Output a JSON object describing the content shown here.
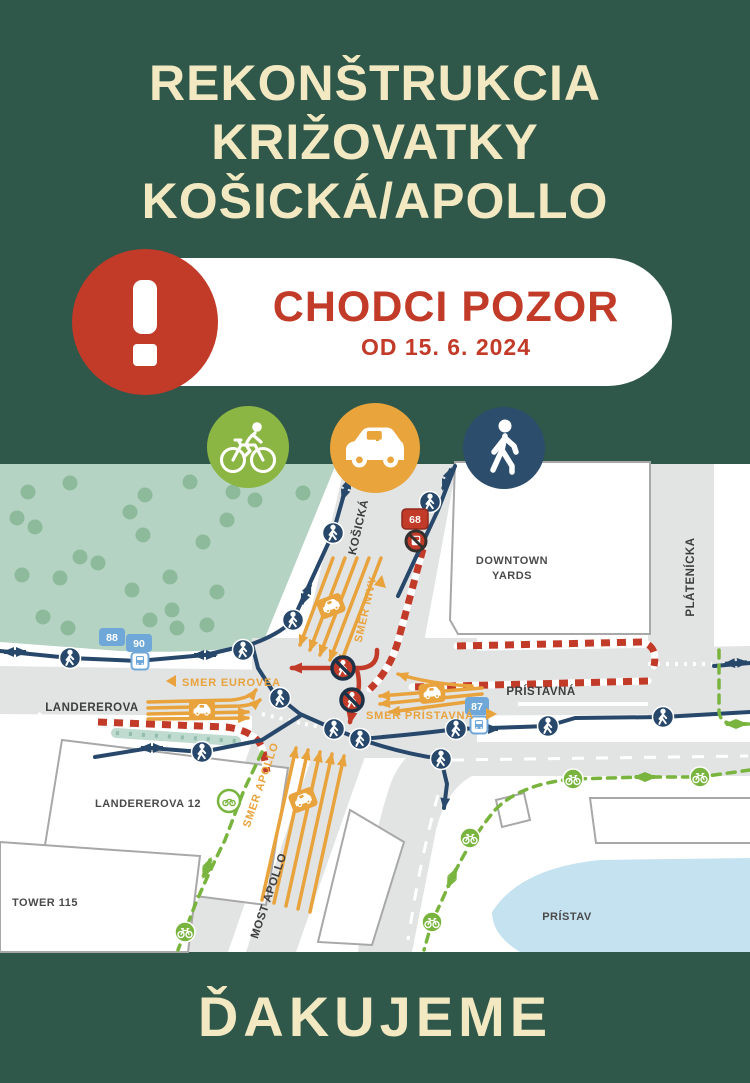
{
  "theme": {
    "background": "#2F574A",
    "title_color": "#F2E9C2",
    "alert_red": "#C23A28",
    "pill_bg": "#FFFFFF"
  },
  "header": {
    "title_lines": [
      "REKONŠTRUKCIA",
      "KRIŽOVATKY",
      "KOŠICKÁ/APOLLO"
    ]
  },
  "alert": {
    "headline": "CHODCI POZOR",
    "date_label": "OD 15. 6. 2024"
  },
  "modes": [
    {
      "id": "cyclist",
      "color": "#8CB644"
    },
    {
      "id": "car",
      "color": "#E9A43C"
    },
    {
      "id": "pedestrian",
      "color": "#2D4D6D"
    }
  ],
  "map": {
    "streets": {
      "kosicka": "KOŠICKÁ",
      "platenicka": "PLÁTENÍCKA",
      "pristavna": "PRÍSTAVNÁ",
      "landererova": "LANDEREROVA",
      "most_apollo": "MOST APOLLO"
    },
    "directions": {
      "smer_nivy": "SMER NIVY",
      "smer_eurovea": "SMER EUROVEA",
      "smer_pristavna": "SMER PRÍSTAVNÁ",
      "smer_apollo": "SMER APOLLO"
    },
    "places": {
      "downtown_line1": "DOWNTOWN",
      "downtown_line2": "YARDS",
      "landererova12": "LANDEREROVA 12",
      "tower115": "TOWER 115",
      "pristav": "PRÍSTAV"
    },
    "transit": {
      "line88": "88",
      "line90": "90",
      "line87": "87",
      "line68": "68"
    },
    "colors": {
      "pedestrian_route": "#27486B",
      "car_route": "#E8A33D",
      "bike_route": "#79B43F",
      "closed_route": "#C23A28",
      "barrier_stripe": "#C23A28",
      "park": "#B5D3C3",
      "tree": "#8CBA9B",
      "road": "#E2E3E3",
      "water": "#C5E2F1",
      "transit_blue": "#6FA8D8"
    }
  },
  "footer": {
    "thanks": "ĎAKUJEME"
  }
}
